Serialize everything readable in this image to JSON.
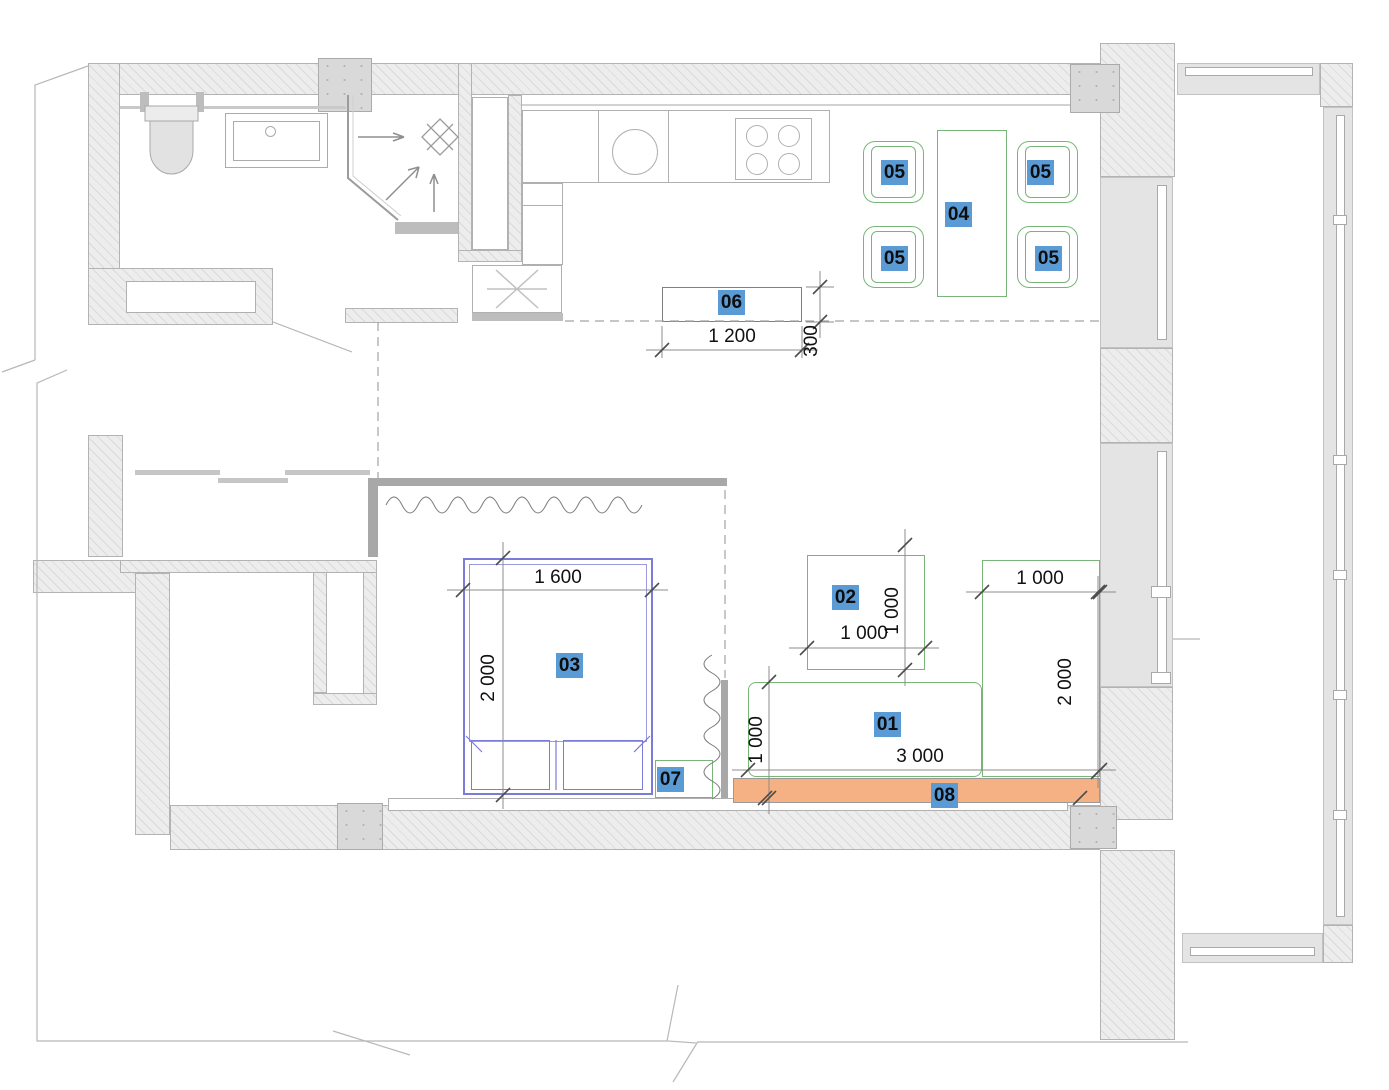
{
  "plan": {
    "tags": {
      "t01": "01",
      "t02": "02",
      "t03": "03",
      "t04": "04",
      "t05": "05",
      "t06": "06",
      "t07": "07",
      "t08": "08"
    },
    "dimensions": {
      "island_width": "1 200",
      "island_depth": "300",
      "bed_width": "1 600",
      "bed_length": "2 000",
      "table02_width": "1 000",
      "table02_depth": "1 000",
      "cabinet_width": "1 000",
      "cabinet_height": "2 000",
      "sofa_depth": "1 000",
      "sofa_width": "3 000"
    },
    "colors": {
      "tag_highlight": "#5b9bd5",
      "furniture_outline_green": "#79b579",
      "bed_outline_blue": "#7b7bd8",
      "accent_orange": "#f5b183",
      "wall_fill": "#ededed",
      "wall_border": "#b3b3b3",
      "dimension_text": "#111111"
    }
  }
}
